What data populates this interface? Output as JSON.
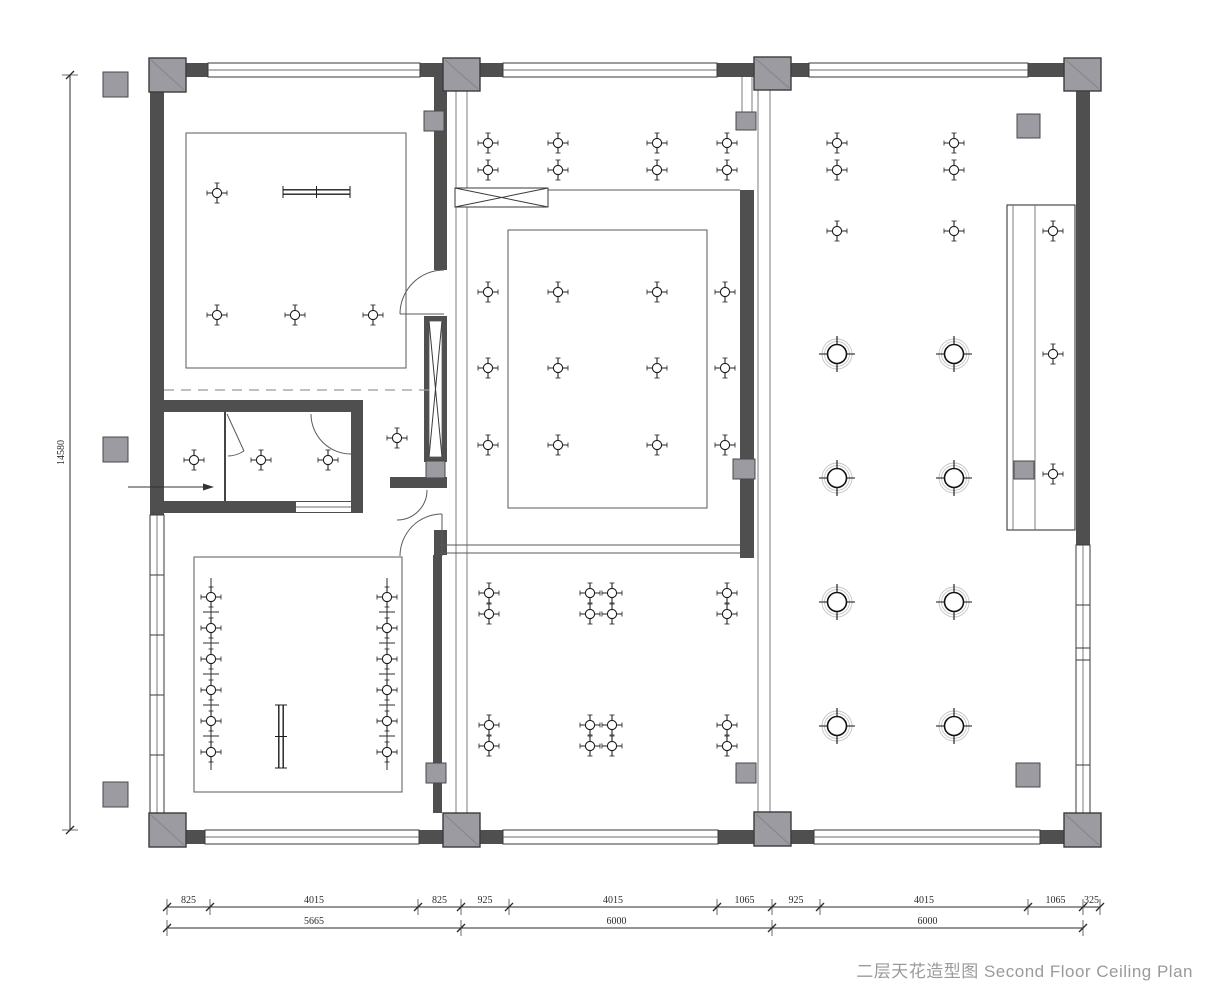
{
  "title": {
    "text": "二层天花造型图 Second Floor Ceiling Plan"
  },
  "colors": {
    "wall": "#4f4f4f",
    "column": "#9b9ba1",
    "line": "#3a3a3a",
    "halo": "#c5c5c5",
    "dim": "#2b2b2b",
    "title": "#9a9a9a"
  },
  "dimensions": {
    "rows": [
      {
        "y": 907,
        "segments": [
          [
            "825",
            167,
            210
          ],
          [
            "4015",
            210,
            418
          ],
          [
            "825",
            418,
            461
          ],
          [
            "925",
            461,
            509
          ],
          [
            "4015",
            509,
            717
          ],
          [
            "1065",
            717,
            772
          ],
          [
            "925",
            772,
            820
          ],
          [
            "4015",
            820,
            1028
          ],
          [
            "1065",
            1028,
            1083
          ],
          [
            "325",
            1083,
            1100
          ]
        ]
      },
      {
        "y": 928,
        "segments": [
          [
            "5665",
            167,
            461
          ],
          [
            "6000",
            461,
            772
          ],
          [
            "6000",
            772,
            1083
          ]
        ]
      }
    ],
    "vertical": {
      "x": 70,
      "y1": 75,
      "y2": 830,
      "label": "14580"
    }
  },
  "fixtures": {
    "small_lights": [
      [
        217,
        193
      ],
      [
        217,
        315
      ],
      [
        295,
        315
      ],
      [
        373,
        315
      ],
      [
        397,
        438
      ],
      [
        194,
        460
      ],
      [
        261,
        460
      ],
      [
        328,
        460
      ],
      [
        488,
        143
      ],
      [
        558,
        143
      ],
      [
        657,
        143
      ],
      [
        727,
        143
      ],
      [
        488,
        170
      ],
      [
        558,
        170
      ],
      [
        657,
        170
      ],
      [
        727,
        170
      ],
      [
        488,
        292
      ],
      [
        558,
        292
      ],
      [
        657,
        292
      ],
      [
        725,
        292
      ],
      [
        488,
        368
      ],
      [
        558,
        368
      ],
      [
        657,
        368
      ],
      [
        725,
        368
      ],
      [
        488,
        445
      ],
      [
        558,
        445
      ],
      [
        657,
        445
      ],
      [
        725,
        445
      ],
      [
        489,
        593
      ],
      [
        590,
        593
      ],
      [
        612,
        593
      ],
      [
        727,
        593
      ],
      [
        489,
        614
      ],
      [
        590,
        614
      ],
      [
        612,
        614
      ],
      [
        727,
        614
      ],
      [
        489,
        725
      ],
      [
        590,
        725
      ],
      [
        612,
        725
      ],
      [
        727,
        725
      ],
      [
        489,
        746
      ],
      [
        590,
        746
      ],
      [
        612,
        746
      ],
      [
        727,
        746
      ],
      [
        837,
        143
      ],
      [
        954,
        143
      ],
      [
        837,
        170
      ],
      [
        954,
        170
      ],
      [
        837,
        231
      ],
      [
        954,
        231
      ],
      [
        1053,
        231
      ],
      [
        1053,
        354
      ],
      [
        1053,
        474
      ],
      [
        211,
        597
      ],
      [
        211,
        628
      ],
      [
        211,
        659
      ],
      [
        211,
        690
      ],
      [
        211,
        721
      ],
      [
        211,
        752
      ],
      [
        387,
        597
      ],
      [
        387,
        628
      ],
      [
        387,
        659
      ],
      [
        387,
        690
      ],
      [
        387,
        721
      ],
      [
        387,
        752
      ]
    ],
    "large_lights": [
      [
        837,
        354
      ],
      [
        954,
        354
      ],
      [
        837,
        478
      ],
      [
        954,
        478
      ],
      [
        837,
        602
      ],
      [
        954,
        602
      ],
      [
        837,
        726
      ],
      [
        954,
        726
      ]
    ],
    "tracks": [
      {
        "x": 211,
        "y1": 578,
        "y2": 770,
        "ticks": [
          612,
          643,
          674,
          705,
          736
        ]
      },
      {
        "x": 387,
        "y1": 578,
        "y2": 770,
        "ticks": [
          612,
          643,
          674,
          705,
          736
        ]
      }
    ],
    "linear_bars": [
      {
        "x1": 283,
        "y1": 192,
        "x2": 350,
        "y2": 192
      },
      {
        "x1": 281,
        "y1": 705,
        "x2": 281,
        "y2": 768
      }
    ],
    "entry_arrow": {
      "x1": 128,
      "y1": 487,
      "x2": 214,
      "y2": 487
    }
  }
}
